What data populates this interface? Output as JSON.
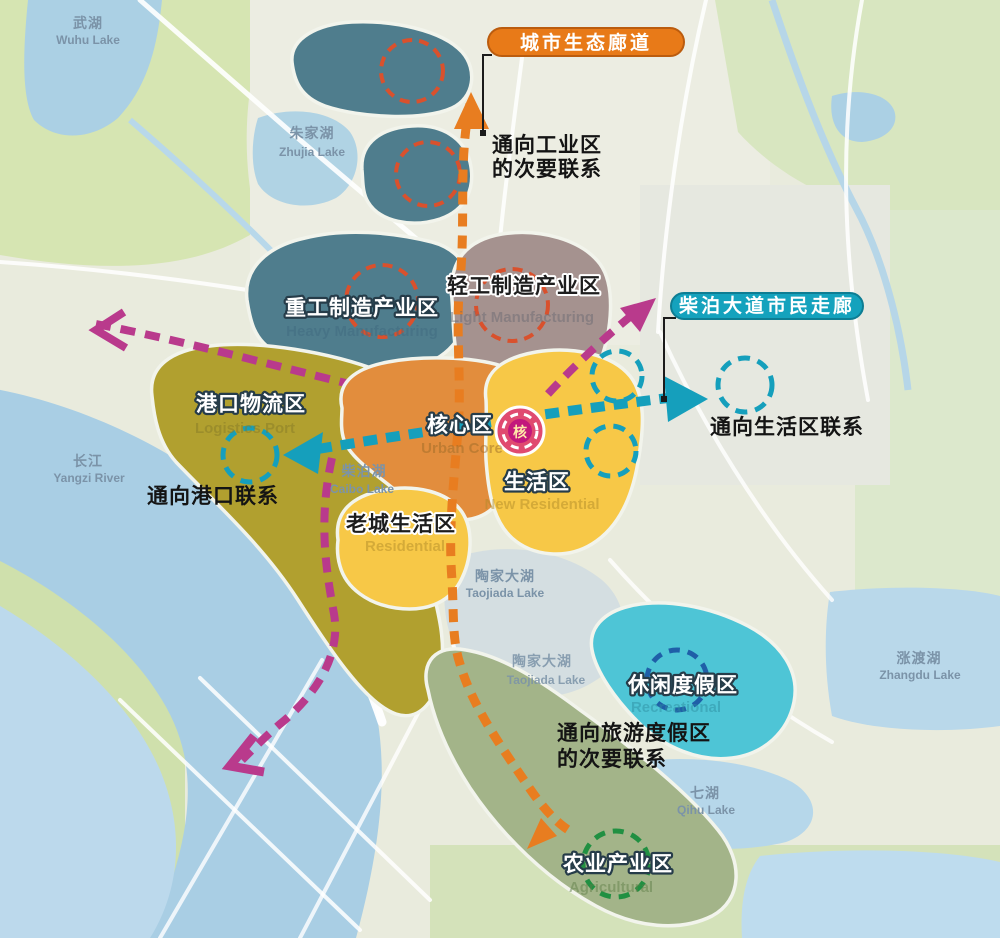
{
  "banners": {
    "eco": {
      "label": "城市生态廊道",
      "color": "#e87a18",
      "border": "#bb5c0e"
    },
    "civic": {
      "label": "柴泊大道市民走廊",
      "color": "#14a2bd",
      "border": "#0d7d93"
    }
  },
  "annotations": {
    "industry_l1": "通向工业区",
    "industry_l2": "的次要联系",
    "living": "通向生活区联系",
    "port": "通向港口联系",
    "tourism_l1": "通向旅游度假区",
    "tourism_l2": "的次要联系"
  },
  "zones": {
    "heavy": {
      "zh": "重工制造产业区",
      "en": "Heavy Manufacturing",
      "color": "#4f7d8d"
    },
    "light": {
      "zh": "轻工制造产业区",
      "en": "Light Manufacturing",
      "color": "#a5928f"
    },
    "logistics": {
      "zh": "港口物流区",
      "en": "Logistics Port",
      "color": "#b1a02f"
    },
    "core": {
      "zh": "核心区",
      "en": "Urban Core",
      "color": "#e28d3d"
    },
    "res_new": {
      "zh": "生活区",
      "en": "New Residential",
      "color": "#f7c847"
    },
    "res_old": {
      "zh": "老城生活区",
      "en": "Residential",
      "color": "#f7c847"
    },
    "leisure": {
      "zh": "休闲度假区",
      "en": "Recreational",
      "color": "#4ec5d6"
    },
    "agri": {
      "zh": "农业产业区",
      "en": "Agricultural",
      "color": "#a3b489"
    }
  },
  "lakes": {
    "wuhu": {
      "zh": "武湖",
      "en": "Wuhu Lake"
    },
    "zhujia": {
      "zh": "朱家湖",
      "en": "Zhujia Lake"
    },
    "yangzi": {
      "zh": "长江",
      "en": "Yangzi River"
    },
    "caibo": {
      "zh": "柴泊湖",
      "en": "Caibo Lake"
    },
    "taojiada": {
      "zh": "陶家大湖",
      "en": "Taojiada Lake"
    },
    "taojiada2": {
      "zh": "陶家大湖",
      "en": "Taojiada Lake"
    },
    "qihu": {
      "zh": "七湖",
      "en": "Qihu Lake"
    },
    "zhangdu": {
      "zh": "涨渡湖",
      "en": "Zhangdu Lake"
    }
  },
  "center_marker": {
    "glyph": "核",
    "color": "#e04a70",
    "inner_color": "#c2187c"
  },
  "corridors": {
    "eco_color": "#e87d20",
    "civic_color": "#159fbc",
    "secondary_color": "#b93a8c",
    "red_circle": "#d9512d",
    "navy_circle": "#1f5fa8",
    "green_circle": "#219042"
  }
}
